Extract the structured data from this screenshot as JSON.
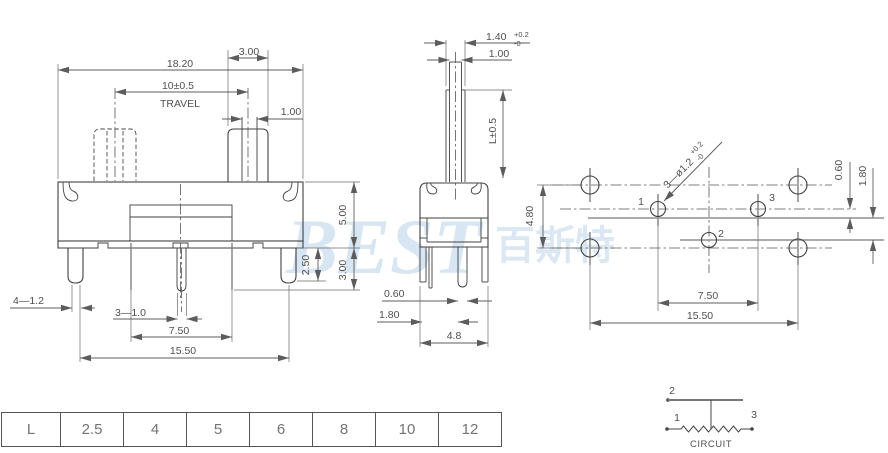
{
  "drawing": {
    "front": {
      "overall_width": "18.20",
      "knob_width": "3.00",
      "travel": "10±0.5",
      "travel_label": "TRAVEL",
      "slot_width": "1.00",
      "body_height": "5.00",
      "mount_pin_length": "2.50",
      "terminal_length": "3.00",
      "mount_pin_note": "4—1.2",
      "terminal_note": "3—1.0",
      "terminal_span": "7.50",
      "mount_span": "15.50"
    },
    "side": {
      "shaft_width": "1.40",
      "shaft_tol_plus": "+0.2",
      "shaft_tol_minus": "-0",
      "tip_width": "1.00",
      "shaft_length": "L±0.5",
      "pin_offset": "0.60",
      "row_offset": "1.80",
      "body_depth": "4.8"
    },
    "pcb": {
      "row_span": "4.80",
      "hole_note": "3—ø1.2",
      "hole_tol_plus": "+0.2",
      "hole_tol_minus": "-0",
      "pin1": "1",
      "pin2": "2",
      "pin3": "3",
      "wiper_offset": "0.60",
      "row2_offset": "1.80",
      "terminal_span": "7.50",
      "mount_span": "15.50"
    }
  },
  "circuit": {
    "pin1": "1",
    "pin2": "2",
    "pin3": "3",
    "caption": "CIRCUIT"
  },
  "size_table": {
    "header": "L",
    "values": [
      "2.5",
      "4",
      "5",
      "6",
      "8",
      "10",
      "12"
    ]
  },
  "watermark": {
    "latin": "BEST",
    "cjk": "百斯特"
  },
  "colors": {
    "line": "#404040",
    "dimension": "#5c5c5c",
    "auxiliary": "#8f8f8f",
    "watermark": "#7fb0d8",
    "table_text": "#737373",
    "background": "#ffffff"
  }
}
